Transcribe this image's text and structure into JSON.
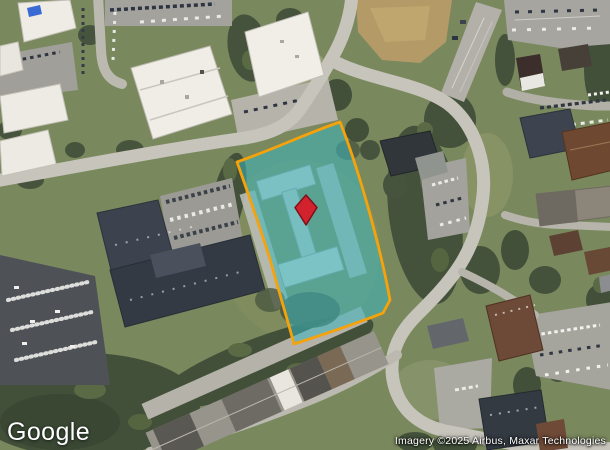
{
  "map": {
    "view_type": "satellite",
    "google_logo": "Google",
    "attribution": "Imagery ©2025 Airbus, Maxar Technologies"
  },
  "parcel_overlay": {
    "fill_color": "#3ab7bf",
    "border_color": "#f6a20a"
  },
  "marker": {
    "shape": "diamond",
    "fill_color": "#d2222d",
    "border_color": "#7d1118"
  }
}
